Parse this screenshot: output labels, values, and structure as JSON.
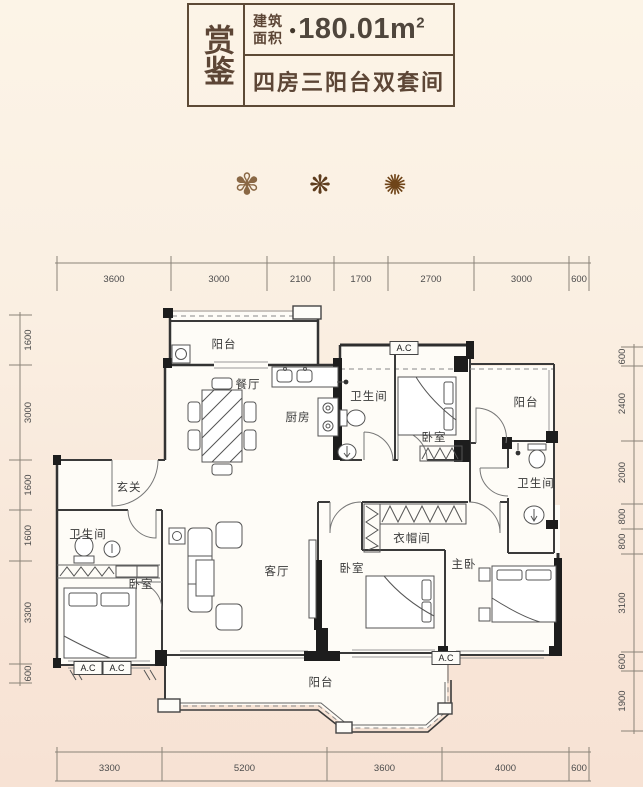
{
  "header": {
    "title_vertical": "赏鉴",
    "area_label_line1": "建筑",
    "area_label_line2": "面积",
    "bullet": "●",
    "area_value": "180.01m",
    "area_sup": "2",
    "subtitle": "四房三阳台双套间"
  },
  "ornaments": {
    "flower1": "✾",
    "flower2": "❋",
    "flower3": "✺"
  },
  "colors": {
    "accent": "#5d4a36",
    "wall": "#1d1d1d",
    "background_top": "#fcf4e7",
    "background_bottom": "#f7e2d4"
  },
  "plan": {
    "room_labels": [
      {
        "text": "阳台",
        "x": 224,
        "y": 348
      },
      {
        "text": "餐厅",
        "x": 248,
        "y": 388
      },
      {
        "text": "厨房",
        "x": 298,
        "y": 421
      },
      {
        "text": "卫生间",
        "x": 369,
        "y": 400
      },
      {
        "text": "卧室",
        "x": 434,
        "y": 441
      },
      {
        "text": "阳台",
        "x": 526,
        "y": 406
      },
      {
        "text": "卫生间",
        "x": 536,
        "y": 487
      },
      {
        "text": "玄关",
        "x": 129,
        "y": 491
      },
      {
        "text": "卫生间",
        "x": 88,
        "y": 538
      },
      {
        "text": "卧室",
        "x": 141,
        "y": 588
      },
      {
        "text": "客厅",
        "x": 277,
        "y": 575
      },
      {
        "text": "卧室",
        "x": 352,
        "y": 572
      },
      {
        "text": "衣帽间",
        "x": 412,
        "y": 542
      },
      {
        "text": "主卧",
        "x": 464,
        "y": 568
      },
      {
        "text": "阳台",
        "x": 321,
        "y": 686
      }
    ],
    "ac_labels": [
      {
        "text": "A.C",
        "x": 404,
        "y": 348
      },
      {
        "text": "A.C",
        "x": 88,
        "y": 668
      },
      {
        "text": "A.C",
        "x": 117,
        "y": 668
      },
      {
        "text": "A.C",
        "x": 446,
        "y": 658
      }
    ],
    "dimensions": {
      "top": {
        "labels": [
          "3600",
          "3000",
          "2100",
          "1700",
          "2700",
          "3000",
          "600"
        ],
        "ticks": [
          57,
          171,
          267,
          334,
          388,
          474,
          569,
          589
        ]
      },
      "bottom": {
        "labels": [
          "3300",
          "5200",
          "3600",
          "4000",
          "600"
        ],
        "ticks": [
          57,
          162,
          327,
          442,
          569,
          589
        ]
      },
      "left": {
        "labels": [
          "1600",
          "3000",
          "1600",
          "1600",
          "3300",
          "600"
        ],
        "ticks": [
          315,
          365,
          460,
          510,
          561,
          664,
          683
        ]
      },
      "right": {
        "labels": [
          "600",
          "2400",
          "2000",
          "800",
          "800",
          "3100",
          "600",
          "1900"
        ],
        "ticks": [
          347,
          366,
          441,
          504,
          529,
          554,
          652,
          671,
          731
        ]
      }
    }
  }
}
